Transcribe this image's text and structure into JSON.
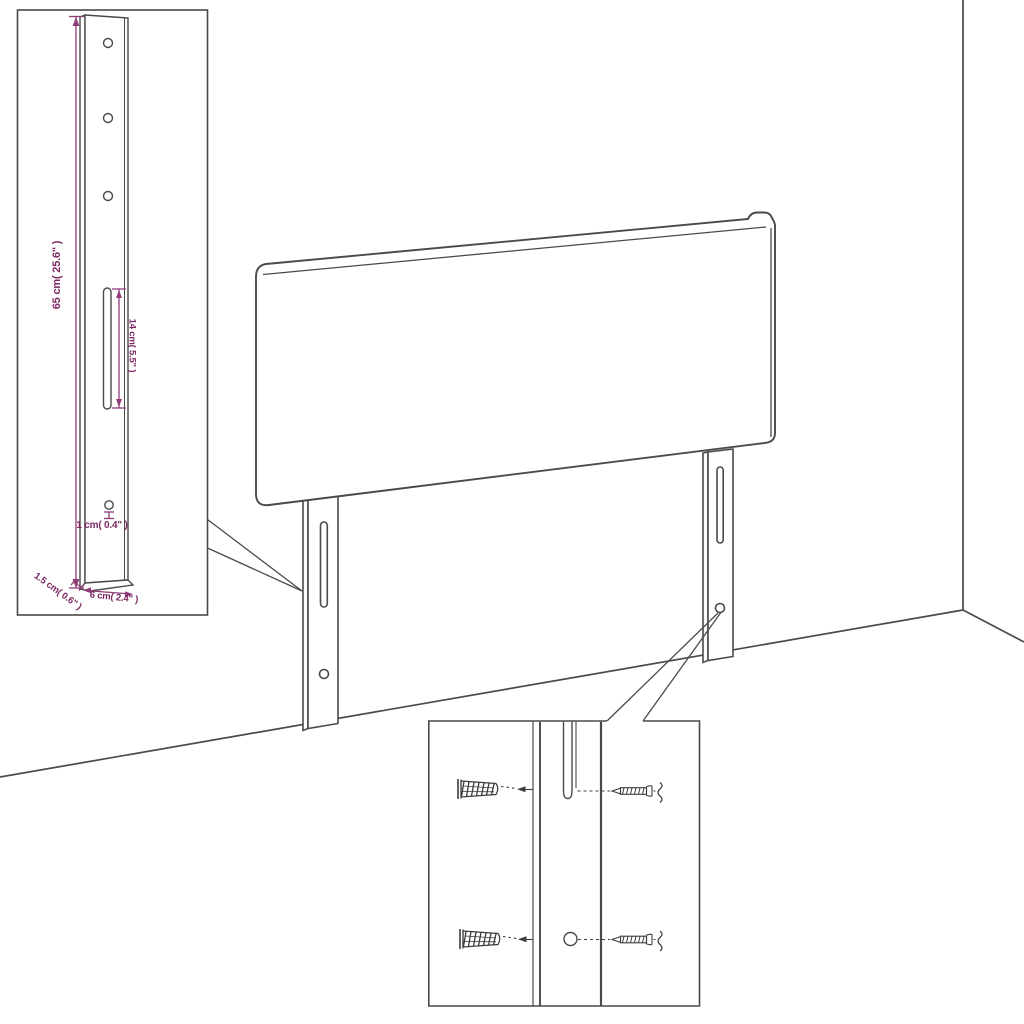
{
  "colors": {
    "background": "#ffffff",
    "line": "#4a4a4a",
    "dimension_line": "#8f3c78",
    "dimension_text": "#7c2862"
  },
  "diagram": {
    "labels": {
      "leg_height": "65 cm( 25.6\" )",
      "slot_length": "14 cm( 5.5\" )",
      "hole_diameter": "1 cm( 0.4\" )",
      "leg_thickness": "1.5 cm( 0.6\" )",
      "leg_width": "6 cm( 2.4\" )"
    }
  }
}
